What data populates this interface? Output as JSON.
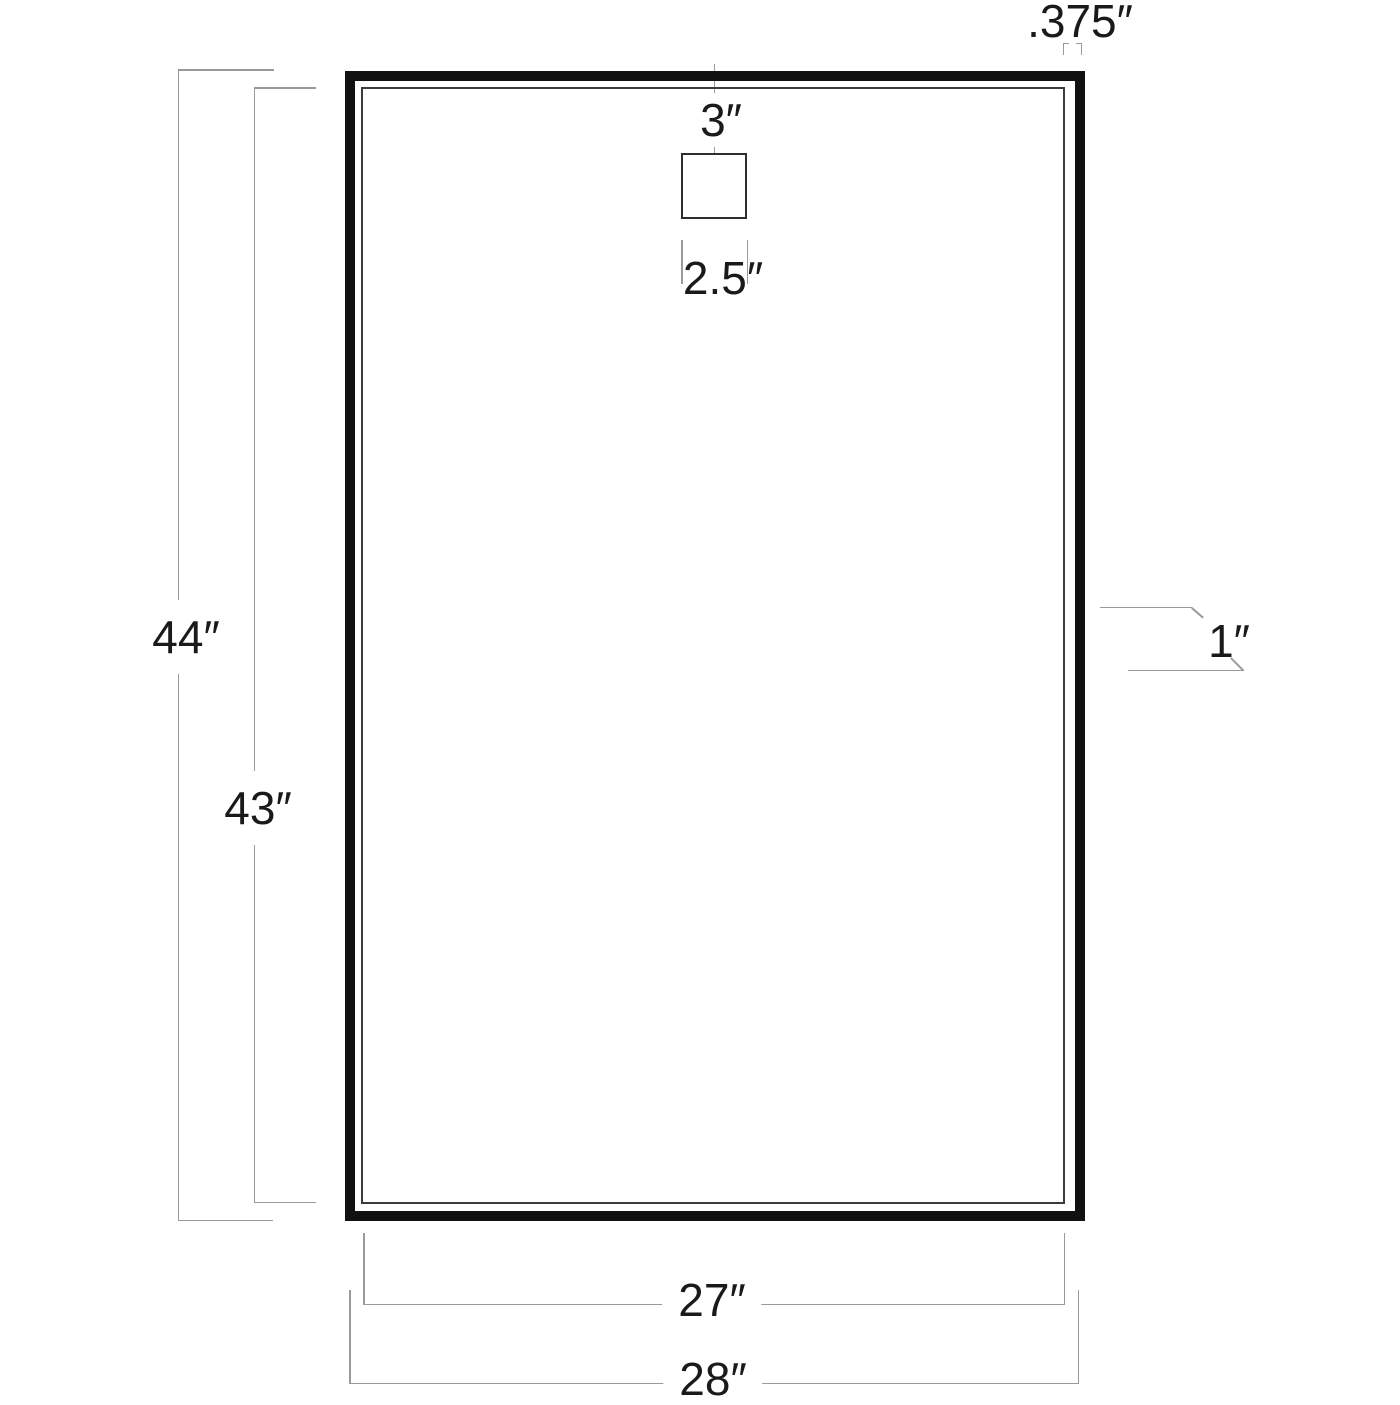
{
  "diagram": {
    "type": "technical-dimension-drawing",
    "subject": "rectangular framed mirror, front view",
    "unit": "inches",
    "labels": {
      "overall_height": "44″",
      "inner_height": "43″",
      "inner_width": "27″",
      "overall_width": "28″",
      "hanger_top_offset": "3″",
      "hanger_width": "2.5″",
      "frame_face": ".375″",
      "depth": "1″"
    },
    "values": {
      "overall_height": 44,
      "inner_height": 43,
      "inner_width": 27,
      "overall_width": 28,
      "hanger_top_offset": 3,
      "hanger_width": 2.5,
      "frame_face": 0.375,
      "depth": 1
    },
    "colors": {
      "background": "#ffffff",
      "frame_border": "#111111",
      "inner_line": "#3c3c3c",
      "dimension_line": "#9a9a9a",
      "text": "#1a1a1a"
    }
  }
}
